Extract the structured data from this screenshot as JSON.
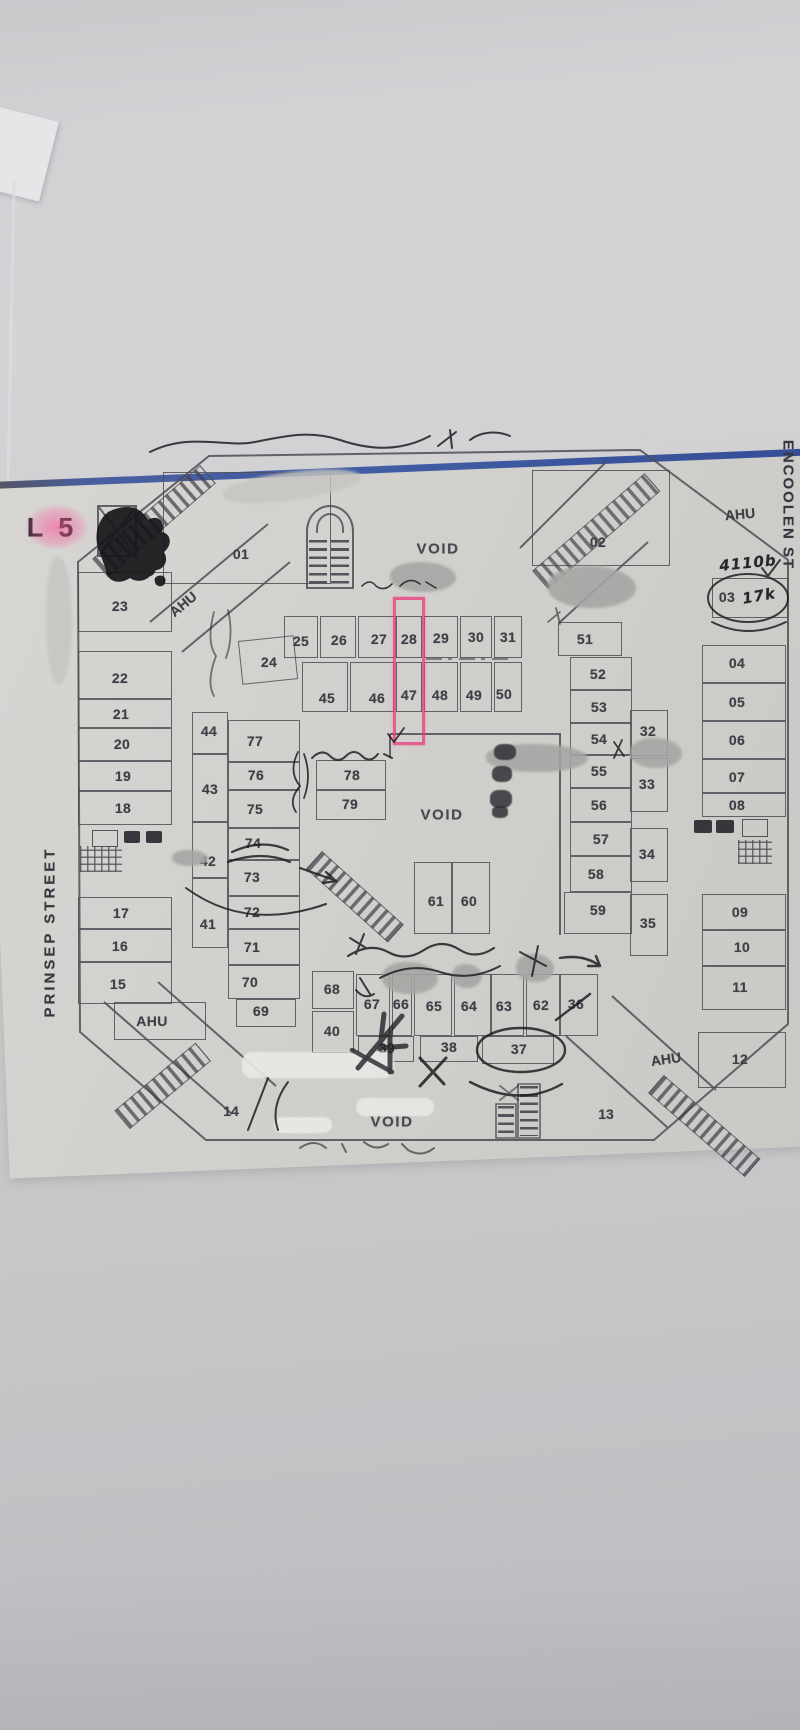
{
  "photo": {
    "highlight_color": "#e8478c",
    "pen_color": "#1e1e23",
    "blue_edge_color": "#35539f",
    "paper_color": "#d3d1ce"
  },
  "plan": {
    "units": [
      {
        "n": "01",
        "box": [
          163,
          472,
          168,
          112
        ],
        "lp": [
          241,
          554
        ]
      },
      {
        "n": "02",
        "box": [
          532,
          470,
          138,
          96
        ],
        "lp": [
          598,
          542
        ]
      },
      {
        "n": "03",
        "box": [
          712,
          578,
          76,
          40
        ],
        "lp": [
          727,
          597
        ]
      },
      {
        "n": "04",
        "box": [
          702,
          645,
          84,
          38
        ],
        "lp": [
          737,
          663
        ]
      },
      {
        "n": "05",
        "box": [
          702,
          683,
          84,
          38
        ],
        "lp": [
          737,
          702
        ]
      },
      {
        "n": "06",
        "box": [
          702,
          721,
          84,
          38
        ],
        "lp": [
          737,
          740
        ]
      },
      {
        "n": "07",
        "box": [
          702,
          759,
          84,
          34
        ],
        "lp": [
          737,
          777
        ]
      },
      {
        "n": "08",
        "box": [
          702,
          793,
          84,
          24
        ],
        "lp": [
          737,
          805
        ]
      },
      {
        "n": "09",
        "box": [
          702,
          894,
          84,
          36
        ],
        "lp": [
          740,
          912
        ]
      },
      {
        "n": "10",
        "box": [
          702,
          930,
          84,
          36
        ],
        "lp": [
          742,
          947
        ]
      },
      {
        "n": "11",
        "box": [
          702,
          966,
          84,
          44
        ],
        "lp": [
          740,
          987
        ]
      },
      {
        "n": "12",
        "box": [
          698,
          1032,
          88,
          56
        ],
        "lp": [
          740,
          1059
        ]
      },
      {
        "n": "15",
        "box": [
          78,
          962,
          94,
          42
        ],
        "lp": [
          118,
          984
        ]
      },
      {
        "n": "16",
        "box": [
          78,
          929,
          94,
          33
        ],
        "lp": [
          120,
          946
        ]
      },
      {
        "n": "17",
        "box": [
          78,
          897,
          94,
          32
        ],
        "lp": [
          121,
          913
        ]
      },
      {
        "n": "18",
        "box": [
          78,
          791,
          94,
          34
        ],
        "lp": [
          123,
          808
        ]
      },
      {
        "n": "19",
        "box": [
          78,
          761,
          94,
          30
        ],
        "lp": [
          123,
          776
        ]
      },
      {
        "n": "20",
        "box": [
          78,
          728,
          94,
          33
        ],
        "lp": [
          122,
          744
        ]
      },
      {
        "n": "21",
        "box": [
          78,
          699,
          94,
          29
        ],
        "lp": [
          121,
          714
        ]
      },
      {
        "n": "22",
        "box": [
          78,
          651,
          94,
          48
        ],
        "lp": [
          120,
          678
        ]
      },
      {
        "n": "23",
        "box": [
          78,
          572,
          94,
          60
        ],
        "lp": [
          120,
          606
        ]
      },
      {
        "n": "24",
        "box": [
          240,
          638,
          56,
          44
        ],
        "lp": [
          269,
          662
        ],
        "rot": -6
      },
      {
        "n": "25",
        "box": [
          284,
          616,
          34,
          42
        ],
        "lp": [
          301,
          641
        ]
      },
      {
        "n": "26",
        "box": [
          320,
          616,
          36,
          42
        ],
        "lp": [
          339,
          640
        ]
      },
      {
        "n": "27",
        "box": [
          358,
          616,
          38,
          42
        ],
        "lp": [
          379,
          639
        ]
      },
      {
        "n": "28",
        "box": [
          396,
          616,
          26,
          42
        ],
        "lp": [
          409,
          639
        ]
      },
      {
        "n": "29",
        "box": [
          424,
          616,
          34,
          42
        ],
        "lp": [
          441,
          638
        ]
      },
      {
        "n": "30",
        "box": [
          460,
          616,
          32,
          42
        ],
        "lp": [
          476,
          637
        ]
      },
      {
        "n": "31",
        "box": [
          494,
          616,
          28,
          42
        ],
        "lp": [
          508,
          637
        ]
      },
      {
        "n": "45",
        "box": [
          302,
          662,
          46,
          50
        ],
        "lp": [
          327,
          698
        ]
      },
      {
        "n": "46",
        "box": [
          350,
          662,
          44,
          50
        ],
        "lp": [
          377,
          698
        ]
      },
      {
        "n": "47",
        "box": [
          396,
          662,
          26,
          50
        ],
        "lp": [
          409,
          695
        ]
      },
      {
        "n": "48",
        "box": [
          424,
          662,
          34,
          50
        ],
        "lp": [
          440,
          695
        ]
      },
      {
        "n": "49",
        "box": [
          460,
          662,
          32,
          50
        ],
        "lp": [
          474,
          695
        ]
      },
      {
        "n": "50",
        "box": [
          494,
          662,
          28,
          50
        ],
        "lp": [
          504,
          694
        ]
      },
      {
        "n": "44",
        "box": [
          192,
          712,
          36,
          42
        ],
        "lp": [
          209,
          731
        ]
      },
      {
        "n": "77",
        "box": [
          228,
          720,
          72,
          42
        ],
        "lp": [
          255,
          741
        ]
      },
      {
        "n": "76",
        "box": [
          228,
          762,
          72,
          28
        ],
        "lp": [
          256,
          775
        ]
      },
      {
        "n": "43",
        "box": [
          192,
          754,
          36,
          68
        ],
        "lp": [
          210,
          789
        ]
      },
      {
        "n": "75",
        "box": [
          228,
          790,
          72,
          38
        ],
        "lp": [
          255,
          809
        ]
      },
      {
        "n": "74",
        "box": [
          228,
          828,
          72,
          32
        ],
        "lp": [
          253,
          843
        ]
      },
      {
        "n": "42",
        "box": [
          192,
          822,
          36,
          56
        ],
        "lp": [
          208,
          861
        ]
      },
      {
        "n": "73",
        "box": [
          228,
          860,
          72,
          36
        ],
        "lp": [
          252,
          877
        ]
      },
      {
        "n": "72",
        "box": [
          228,
          896,
          72,
          33
        ],
        "lp": [
          252,
          912
        ]
      },
      {
        "n": "41",
        "box": [
          192,
          878,
          36,
          70
        ],
        "lp": [
          208,
          924
        ]
      },
      {
        "n": "71",
        "box": [
          228,
          929,
          72,
          36
        ],
        "lp": [
          252,
          947
        ]
      },
      {
        "n": "70",
        "box": [
          228,
          965,
          72,
          34
        ],
        "lp": [
          250,
          982
        ]
      },
      {
        "n": "69",
        "box": [
          236,
          999,
          60,
          28
        ],
        "lp": [
          261,
          1011
        ]
      },
      {
        "n": "78",
        "box": [
          316,
          760,
          70,
          30
        ],
        "lp": [
          352,
          775
        ]
      },
      {
        "n": "79",
        "box": [
          316,
          790,
          70,
          30
        ],
        "lp": [
          350,
          804
        ]
      },
      {
        "n": "51",
        "box": [
          558,
          622,
          64,
          34
        ],
        "lp": [
          585,
          639
        ]
      },
      {
        "n": "52",
        "box": [
          570,
          657,
          62,
          33
        ],
        "lp": [
          598,
          674
        ]
      },
      {
        "n": "53",
        "box": [
          570,
          690,
          62,
          33
        ],
        "lp": [
          599,
          707
        ]
      },
      {
        "n": "54",
        "box": [
          570,
          723,
          62,
          32
        ],
        "lp": [
          599,
          739
        ]
      },
      {
        "n": "55",
        "box": [
          570,
          755,
          62,
          33
        ],
        "lp": [
          599,
          771
        ]
      },
      {
        "n": "56",
        "box": [
          570,
          788,
          62,
          34
        ],
        "lp": [
          599,
          805
        ]
      },
      {
        "n": "57",
        "box": [
          570,
          822,
          62,
          34
        ],
        "lp": [
          601,
          839
        ]
      },
      {
        "n": "58",
        "box": [
          570,
          856,
          62,
          36
        ],
        "lp": [
          596,
          874
        ]
      },
      {
        "n": "59",
        "box": [
          564,
          892,
          68,
          42
        ],
        "lp": [
          598,
          910
        ]
      },
      {
        "n": "32",
        "box": [
          630,
          710,
          38,
          46
        ],
        "lp": [
          648,
          731
        ]
      },
      {
        "n": "33",
        "box": [
          630,
          758,
          38,
          54
        ],
        "lp": [
          647,
          784
        ]
      },
      {
        "n": "34",
        "box": [
          630,
          828,
          38,
          54
        ],
        "lp": [
          647,
          854
        ]
      },
      {
        "n": "35",
        "box": [
          630,
          894,
          38,
          62
        ],
        "lp": [
          648,
          923
        ]
      },
      {
        "n": "61",
        "box": [
          414,
          862,
          38,
          72
        ],
        "lp": [
          436,
          901
        ]
      },
      {
        "n": "60",
        "box": [
          452,
          862,
          38,
          72
        ],
        "lp": [
          469,
          901
        ]
      },
      {
        "n": "68",
        "box": [
          312,
          971,
          42,
          38
        ],
        "lp": [
          332,
          989
        ]
      },
      {
        "n": "40",
        "box": [
          312,
          1011,
          42,
          42
        ],
        "lp": [
          332,
          1031
        ]
      },
      {
        "n": "67",
        "box": [
          356,
          974,
          34,
          62
        ],
        "lp": [
          372,
          1004
        ]
      },
      {
        "n": "66",
        "box": [
          392,
          974,
          20,
          62
        ],
        "lp": [
          401,
          1004
        ]
      },
      {
        "n": "65",
        "box": [
          414,
          974,
          38,
          62
        ],
        "lp": [
          434,
          1006
        ]
      },
      {
        "n": "64",
        "box": [
          454,
          974,
          38,
          62
        ],
        "lp": [
          469,
          1006
        ]
      },
      {
        "n": "63",
        "box": [
          490,
          974,
          34,
          62
        ],
        "lp": [
          504,
          1006
        ]
      },
      {
        "n": "62",
        "box": [
          526,
          974,
          34,
          62
        ],
        "lp": [
          541,
          1005
        ]
      },
      {
        "n": "36",
        "box": [
          560,
          974,
          38,
          62
        ],
        "lp": [
          576,
          1004
        ]
      },
      {
        "n": "39",
        "box": [
          358,
          1036,
          56,
          26
        ],
        "lp": [
          387,
          1048
        ]
      },
      {
        "n": "38",
        "box": [
          420,
          1036,
          58,
          26
        ],
        "lp": [
          449,
          1047
        ]
      },
      {
        "n": "37",
        "box": [
          482,
          1036,
          72,
          28
        ],
        "lp": [
          519,
          1049
        ]
      },
      {
        "n": "AHU",
        "box": [
          114,
          1002,
          92,
          38
        ],
        "lp": [
          152,
          1021
        ]
      }
    ],
    "texts": [
      {
        "t": "L 5",
        "x": 52,
        "y": 528,
        "cls": "floor"
      },
      {
        "t": "VOID",
        "x": 438,
        "y": 549,
        "cls": "void"
      },
      {
        "t": "VOID",
        "x": 442,
        "y": 815,
        "cls": "void"
      },
      {
        "t": "VOID",
        "x": 392,
        "y": 1122,
        "cls": "void"
      },
      {
        "t": "13",
        "x": 606,
        "y": 1114,
        "cls": ""
      },
      {
        "t": "14",
        "x": 231,
        "y": 1111,
        "cls": ""
      },
      {
        "t": "AHU",
        "x": 183,
        "y": 604,
        "rot": -40,
        "cls": ""
      },
      {
        "t": "AHU",
        "x": 740,
        "y": 514,
        "rot": -5,
        "cls": ""
      },
      {
        "t": "AHU",
        "x": 666,
        "y": 1059,
        "rot": -8,
        "cls": ""
      },
      {
        "t": "PRINSEP STREET",
        "x": 50,
        "y": 932,
        "cls": "street-v"
      },
      {
        "t": "ENCOOLEN ST",
        "x": 788,
        "y": 505,
        "cls": "street-v2"
      },
      {
        "t": "4110b",
        "x": 748,
        "y": 563,
        "rot": -6,
        "cls": "hand"
      },
      {
        "t": "17k",
        "x": 759,
        "y": 596,
        "rot": -10,
        "cls": "hand"
      }
    ]
  }
}
